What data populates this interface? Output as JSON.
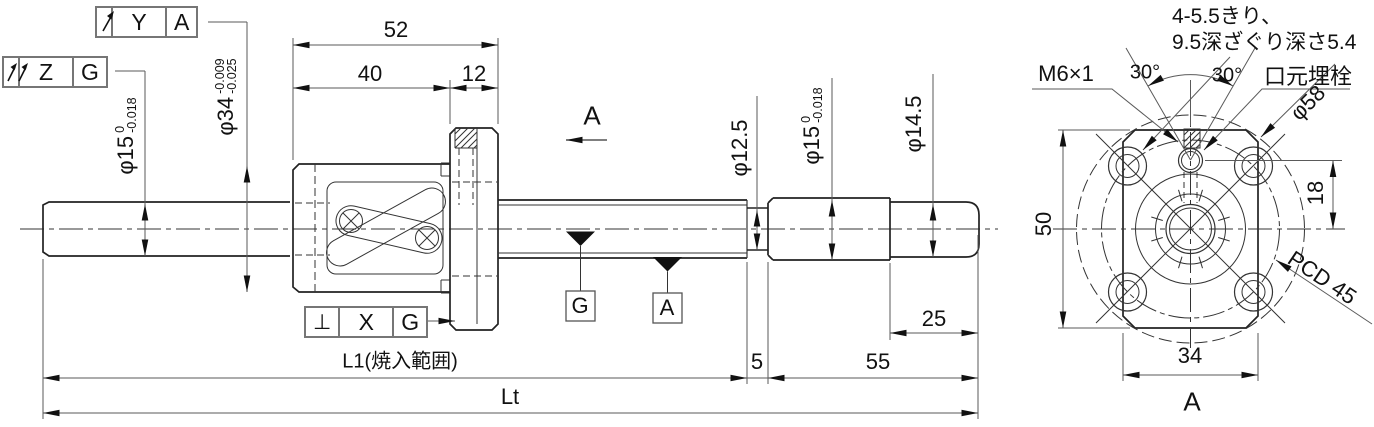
{
  "gdt_frames": {
    "runout": {
      "symbol": "circular-runout",
      "zone": "Y",
      "datum": "A"
    },
    "total_runout": {
      "symbol": "total-runout",
      "zone": "Z",
      "datum": "G"
    },
    "perpendicularity": {
      "symbol": "⊥",
      "zone": "X",
      "datum": "G"
    }
  },
  "main_view": {
    "dims": {
      "d52": "52",
      "d40": "40",
      "d12": "12",
      "dia34": {
        "value": "φ34",
        "tol_up": "-0.009",
        "tol_lo": "-0.025"
      },
      "dia15_left": {
        "value": "φ15",
        "tol_up": "0",
        "tol_lo": "-0.018"
      },
      "dia12_5": "φ12.5",
      "dia15_right": {
        "value": "φ15",
        "tol_up": "0",
        "tol_lo": "-0.018"
      },
      "dia14_5": "φ14.5",
      "d25": "25",
      "d5": "5",
      "d55": "55",
      "L1": "L1(焼入範囲)",
      "Lt": "Lt"
    },
    "section_arrow_label": "A",
    "datum_targets": {
      "g": "G",
      "a": "A"
    }
  },
  "end_view": {
    "notes": {
      "counterbore_line1": "4-5.5きり、",
      "counterbore_line2": "9.5深ざぐり深さ5.4",
      "thread": "M6×1",
      "plug": "口元埋栓"
    },
    "dims": {
      "angle_left": "30°",
      "angle_right": "30°",
      "dia58": "φ58",
      "d50": "50",
      "d18": "18",
      "pcd": "PCD 45",
      "d34": "34"
    },
    "view_label": "A"
  }
}
